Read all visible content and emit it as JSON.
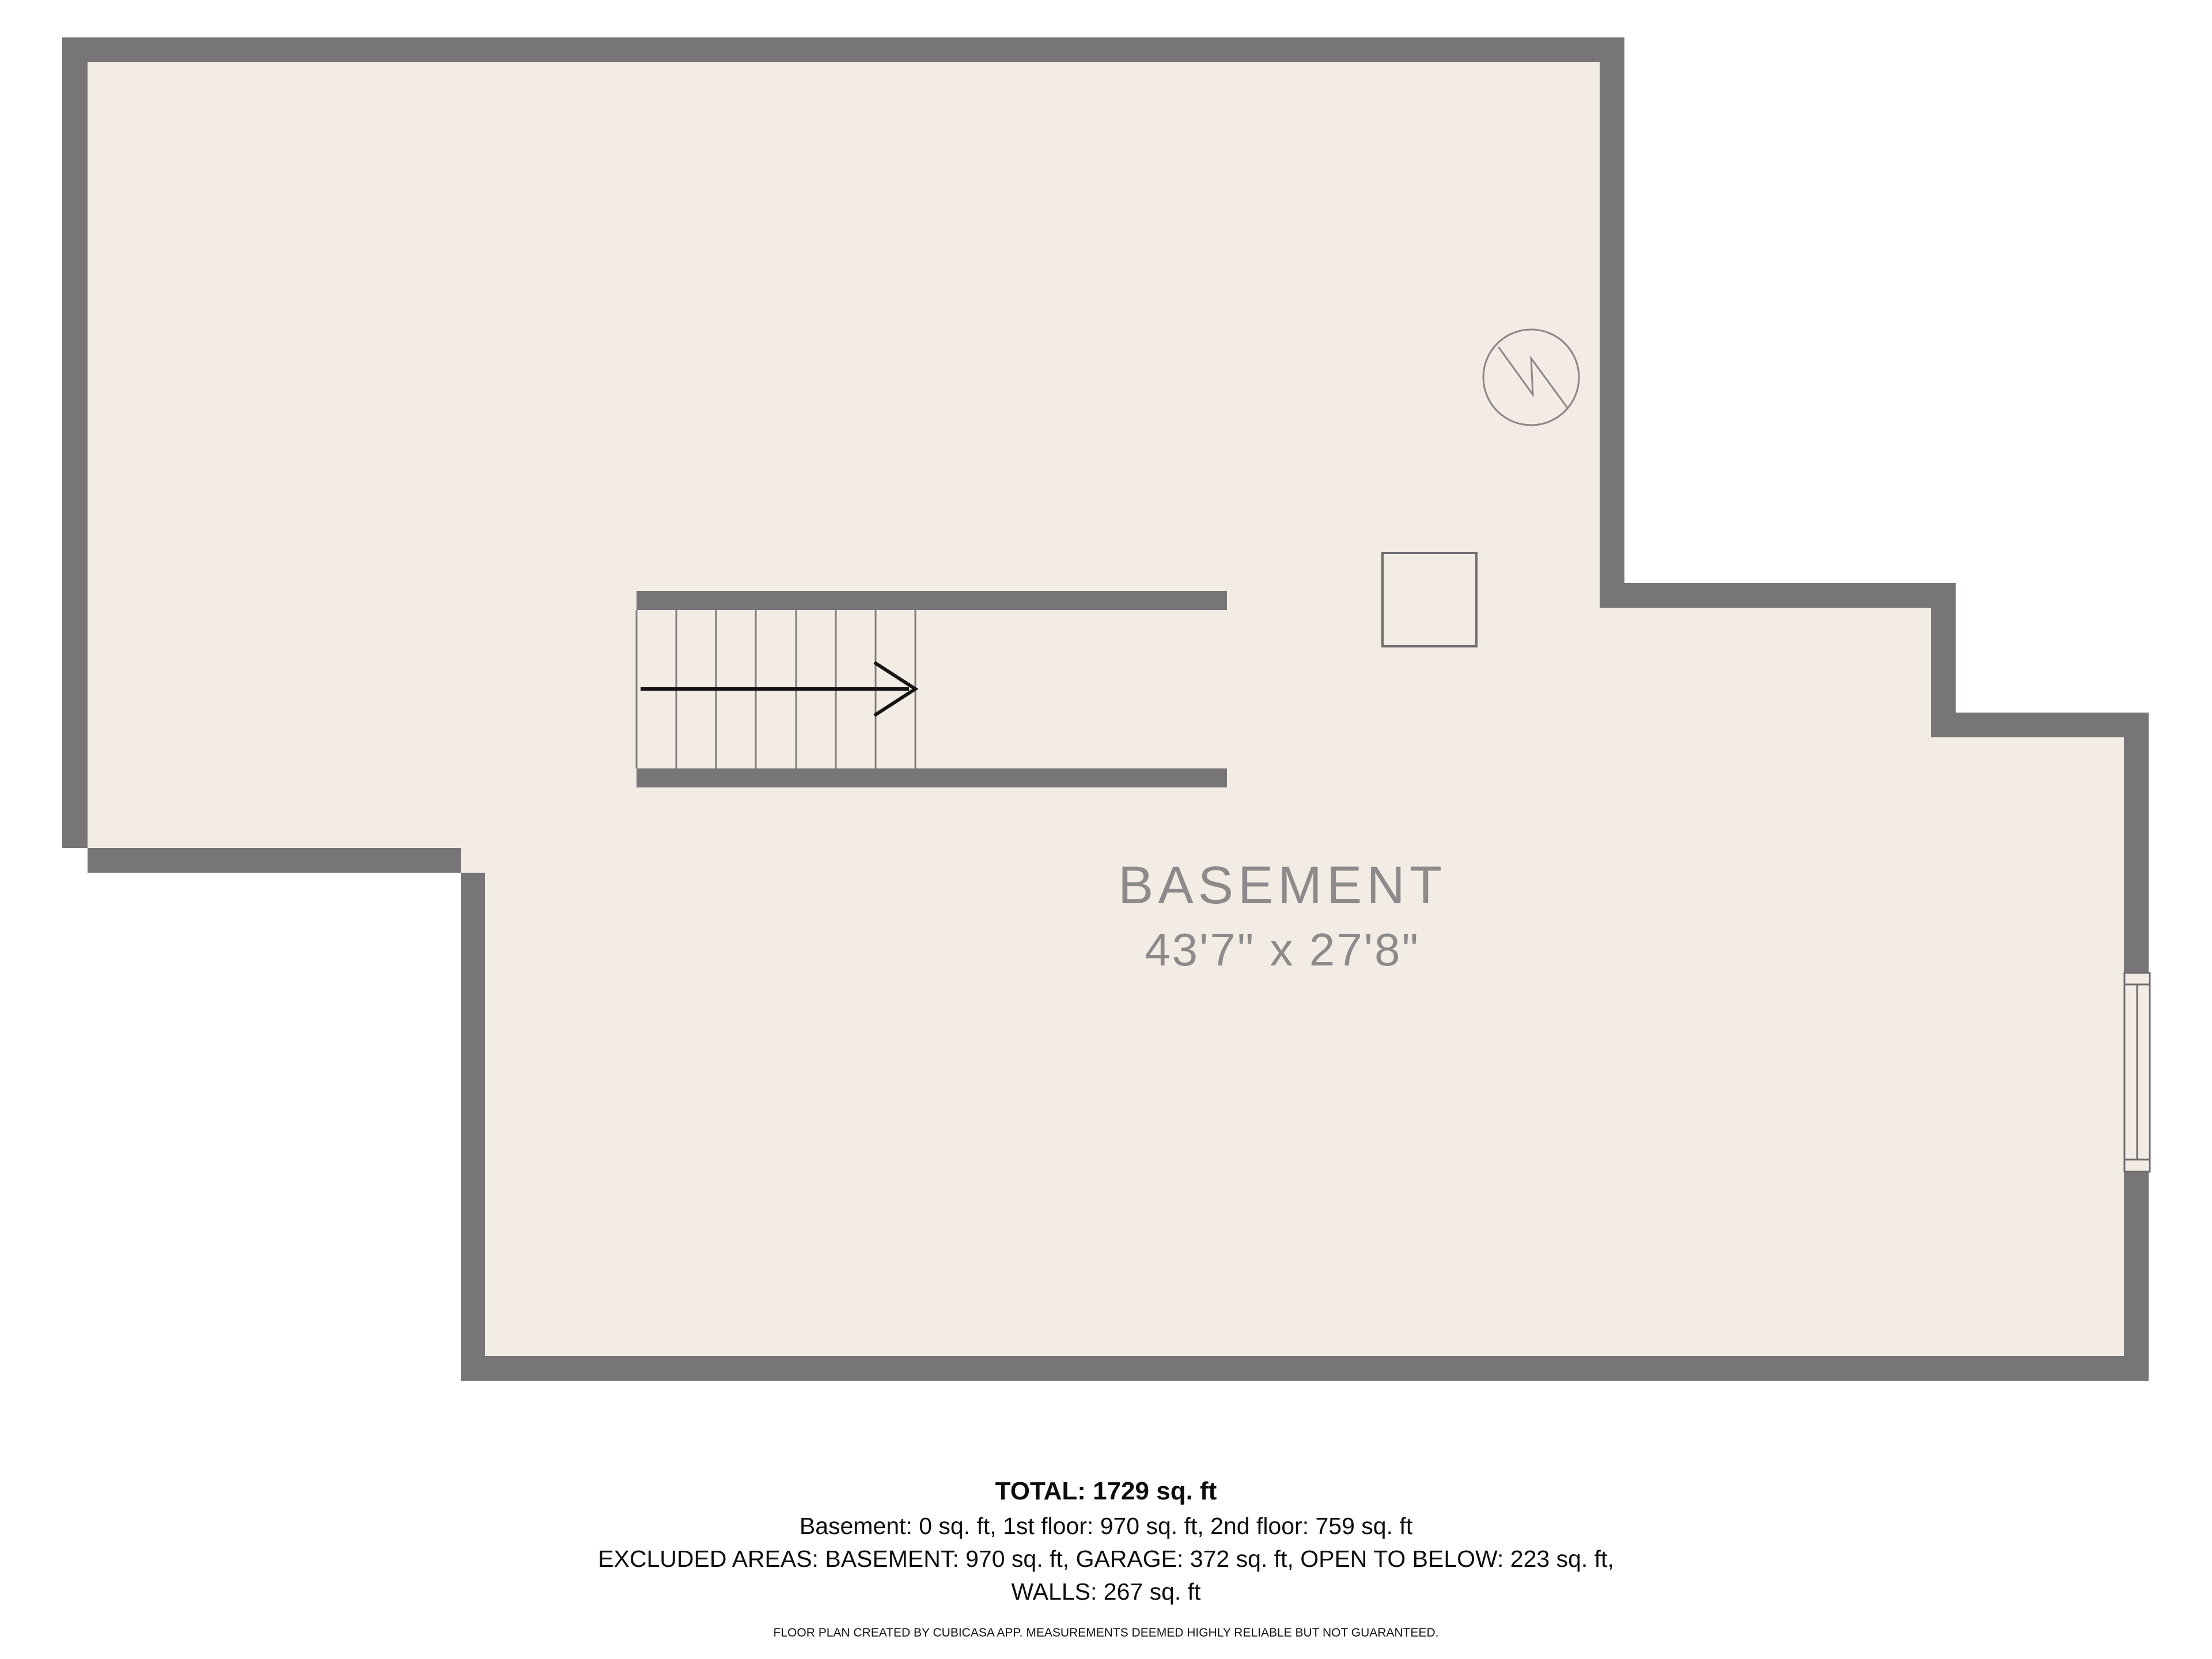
{
  "colors": {
    "background": "#ffffff",
    "wall": "#777577",
    "floor": "#f3ece5",
    "stair_tread_line": "#7f7d7f",
    "symbol_stroke": "#8b8588",
    "fixture_stroke": "#6f6d6f",
    "arrow": "#141414",
    "room_label": "#8c8a8b",
    "summary_text": "#0d0d0d"
  },
  "floorplan": {
    "room": {
      "name": "BASEMENT",
      "dimensions": "43'7\" x 27'8\""
    },
    "symbols": {
      "stairs": "staircase with up-direction arrow",
      "water_heater": "circle with zigzag (water heater)",
      "fixture": "square fixture (support post / utility)",
      "window": "double window on right wall"
    }
  },
  "summary": {
    "total": "TOTAL: 1729 sq. ft",
    "floors": "Basement: 0 sq. ft, 1st floor: 970 sq. ft, 2nd floor: 759 sq. ft",
    "excluded": "EXCLUDED AREAS: BASEMENT: 970 sq. ft, GARAGE: 372 sq. ft, OPEN TO BELOW: 223 sq. ft,",
    "walls": "WALLS: 267 sq. ft"
  },
  "disclaimer": "FLOOR PLAN CREATED BY CUBICASA APP. MEASUREMENTS DEEMED HIGHLY RELIABLE BUT NOT GUARANTEED."
}
